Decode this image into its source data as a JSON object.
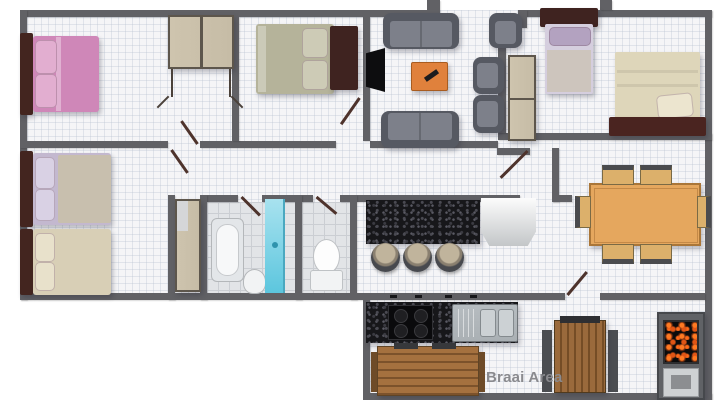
{
  "page": {
    "type": "residential-floor-plan"
  },
  "labels": {
    "braai_area": "Braai Area"
  },
  "colors": {
    "wall": "#616165",
    "floor": "#f5f5f7",
    "tile": "#e2e4e7",
    "headboard": "#43251f",
    "bed_pink": "#cf87b8",
    "bed_sage": "#b5b39a",
    "bed_cream": "#d8cfb6",
    "bed_lavender": "#c3b8cf",
    "sofa_gray": "#565962",
    "seat_gray": "#7d808a",
    "wardrobe_tan": "#c6bca6",
    "shower_blue": "#5cc6de",
    "granite_black": "#17171a",
    "wood_brown": "#9a6a3c",
    "dining_table": "#e5a75e",
    "coffee_table": "#e0813c",
    "chair_tan": "#dcb06b",
    "label_gray": "#8a8a8e",
    "fire_orange": "#ff7a22",
    "steel": "#aab0b4"
  },
  "rooms": [
    "bedroom-top-left",
    "bedroom-middle",
    "living-room",
    "bedroom-right",
    "bedroom-bottom-left",
    "bathroom",
    "toilet",
    "kitchen",
    "dining-area",
    "hallway",
    "braai-area"
  ],
  "furniture": [
    {
      "room": "bedroom-top-left",
      "items": [
        "double-bed-pink",
        "wardrobe-two-door"
      ]
    },
    {
      "room": "bedroom-middle",
      "items": [
        "double-bed-sage"
      ]
    },
    {
      "room": "living-room",
      "items": [
        "sofa",
        "sofa",
        "armchair",
        "armchair",
        "armchair",
        "coffee-table",
        "tv"
      ]
    },
    {
      "room": "bedroom-right",
      "items": [
        "single-bed",
        "double-bed-cream",
        "tall-cabinet"
      ]
    },
    {
      "room": "bedroom-bottom-left",
      "items": [
        "single-bed-lavender",
        "single-bed-cream"
      ]
    },
    {
      "room": "bathroom",
      "items": [
        "bathtub",
        "basin",
        "shower"
      ]
    },
    {
      "room": "toilet",
      "items": [
        "toilet"
      ]
    },
    {
      "room": "kitchen",
      "items": [
        "granite-bar",
        "bar-stool",
        "bar-stool",
        "bar-stool",
        "fridge",
        "stove",
        "double-sink"
      ]
    },
    {
      "room": "dining-area",
      "items": [
        "dining-table",
        "chair",
        "chair",
        "chair",
        "chair",
        "chair",
        "chair"
      ]
    },
    {
      "room": "braai-area",
      "items": [
        "wood-bench",
        "picnic-table",
        "braai-grill"
      ]
    }
  ]
}
